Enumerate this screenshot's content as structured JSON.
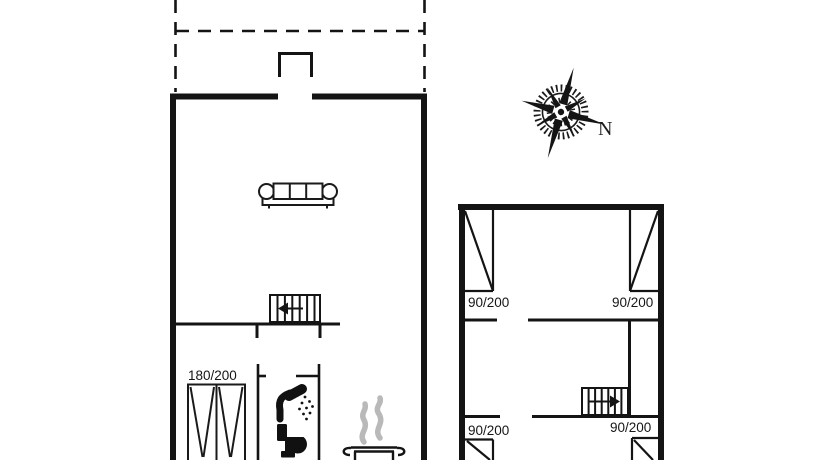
{
  "colors": {
    "line": "#141414",
    "steam_gray": "#b9b9b9",
    "background": "#ffffff"
  },
  "compass": {
    "north_label": "N"
  },
  "left_building": {
    "wardrobe_dimension": "180/200",
    "fixtures": [
      "sofa",
      "staircase-down-arrow-left",
      "wardrobe",
      "shower",
      "toilet",
      "cooking-pot-with-steam"
    ],
    "outline": [
      "dashed-terrace",
      "entrance-porch",
      "solid-outer-walls",
      "interior-wall",
      "bathroom-walls"
    ]
  },
  "right_building": {
    "windows": [
      {
        "position": "top-left",
        "dimension": "90/200"
      },
      {
        "position": "top-right",
        "dimension": "90/200"
      },
      {
        "position": "bottom-left",
        "dimension": "90/200"
      },
      {
        "position": "bottom-right",
        "dimension": "90/200"
      }
    ],
    "fixtures": [
      "staircase-up-arrow-right"
    ],
    "outline": [
      "solid-outer-walls",
      "interior-walls"
    ]
  }
}
